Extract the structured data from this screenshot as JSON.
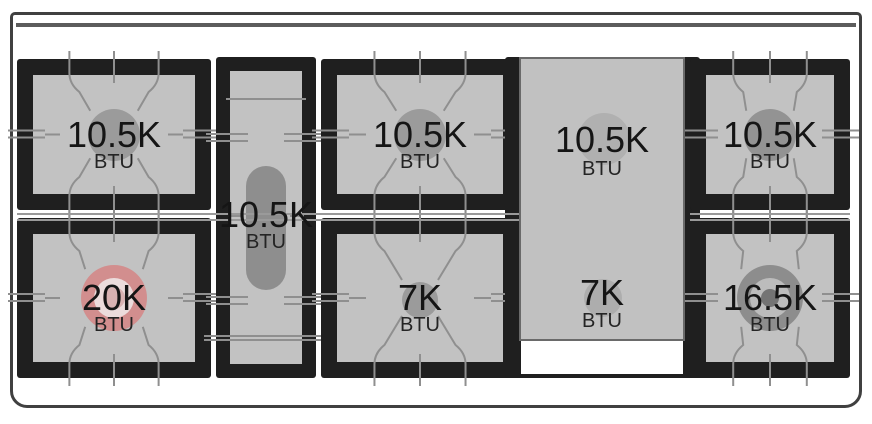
{
  "diagram": {
    "name": "range cooktop burner BTU layout",
    "unit": "BTU",
    "accent_highlight": "#d28e8e",
    "surface_color": "#c2c2c2",
    "frame_color": "#1f1f1f"
  },
  "burners": [
    {
      "id": "left-top",
      "value": "10.5K",
      "unit": "BTU",
      "type": "standard"
    },
    {
      "id": "left-bottom",
      "value": "20K",
      "unit": "BTU",
      "type": "dual-ring-highlight",
      "color": "#d28e8e"
    },
    {
      "id": "center-oval",
      "value": "10.5K",
      "unit": "BTU",
      "type": "oval"
    },
    {
      "id": "middle-top",
      "value": "10.5K",
      "unit": "BTU",
      "type": "standard"
    },
    {
      "id": "middle-bottom",
      "value": "7K",
      "unit": "BTU",
      "type": "standard-small"
    },
    {
      "id": "griddle-top",
      "value": "10.5K",
      "unit": "BTU",
      "type": "under-griddle"
    },
    {
      "id": "griddle-bottom",
      "value": "7K",
      "unit": "BTU",
      "type": "under-griddle"
    },
    {
      "id": "right-top",
      "value": "10.5K",
      "unit": "BTU",
      "type": "standard"
    },
    {
      "id": "right-bottom",
      "value": "16.5K",
      "unit": "BTU",
      "type": "dual-ring"
    }
  ]
}
